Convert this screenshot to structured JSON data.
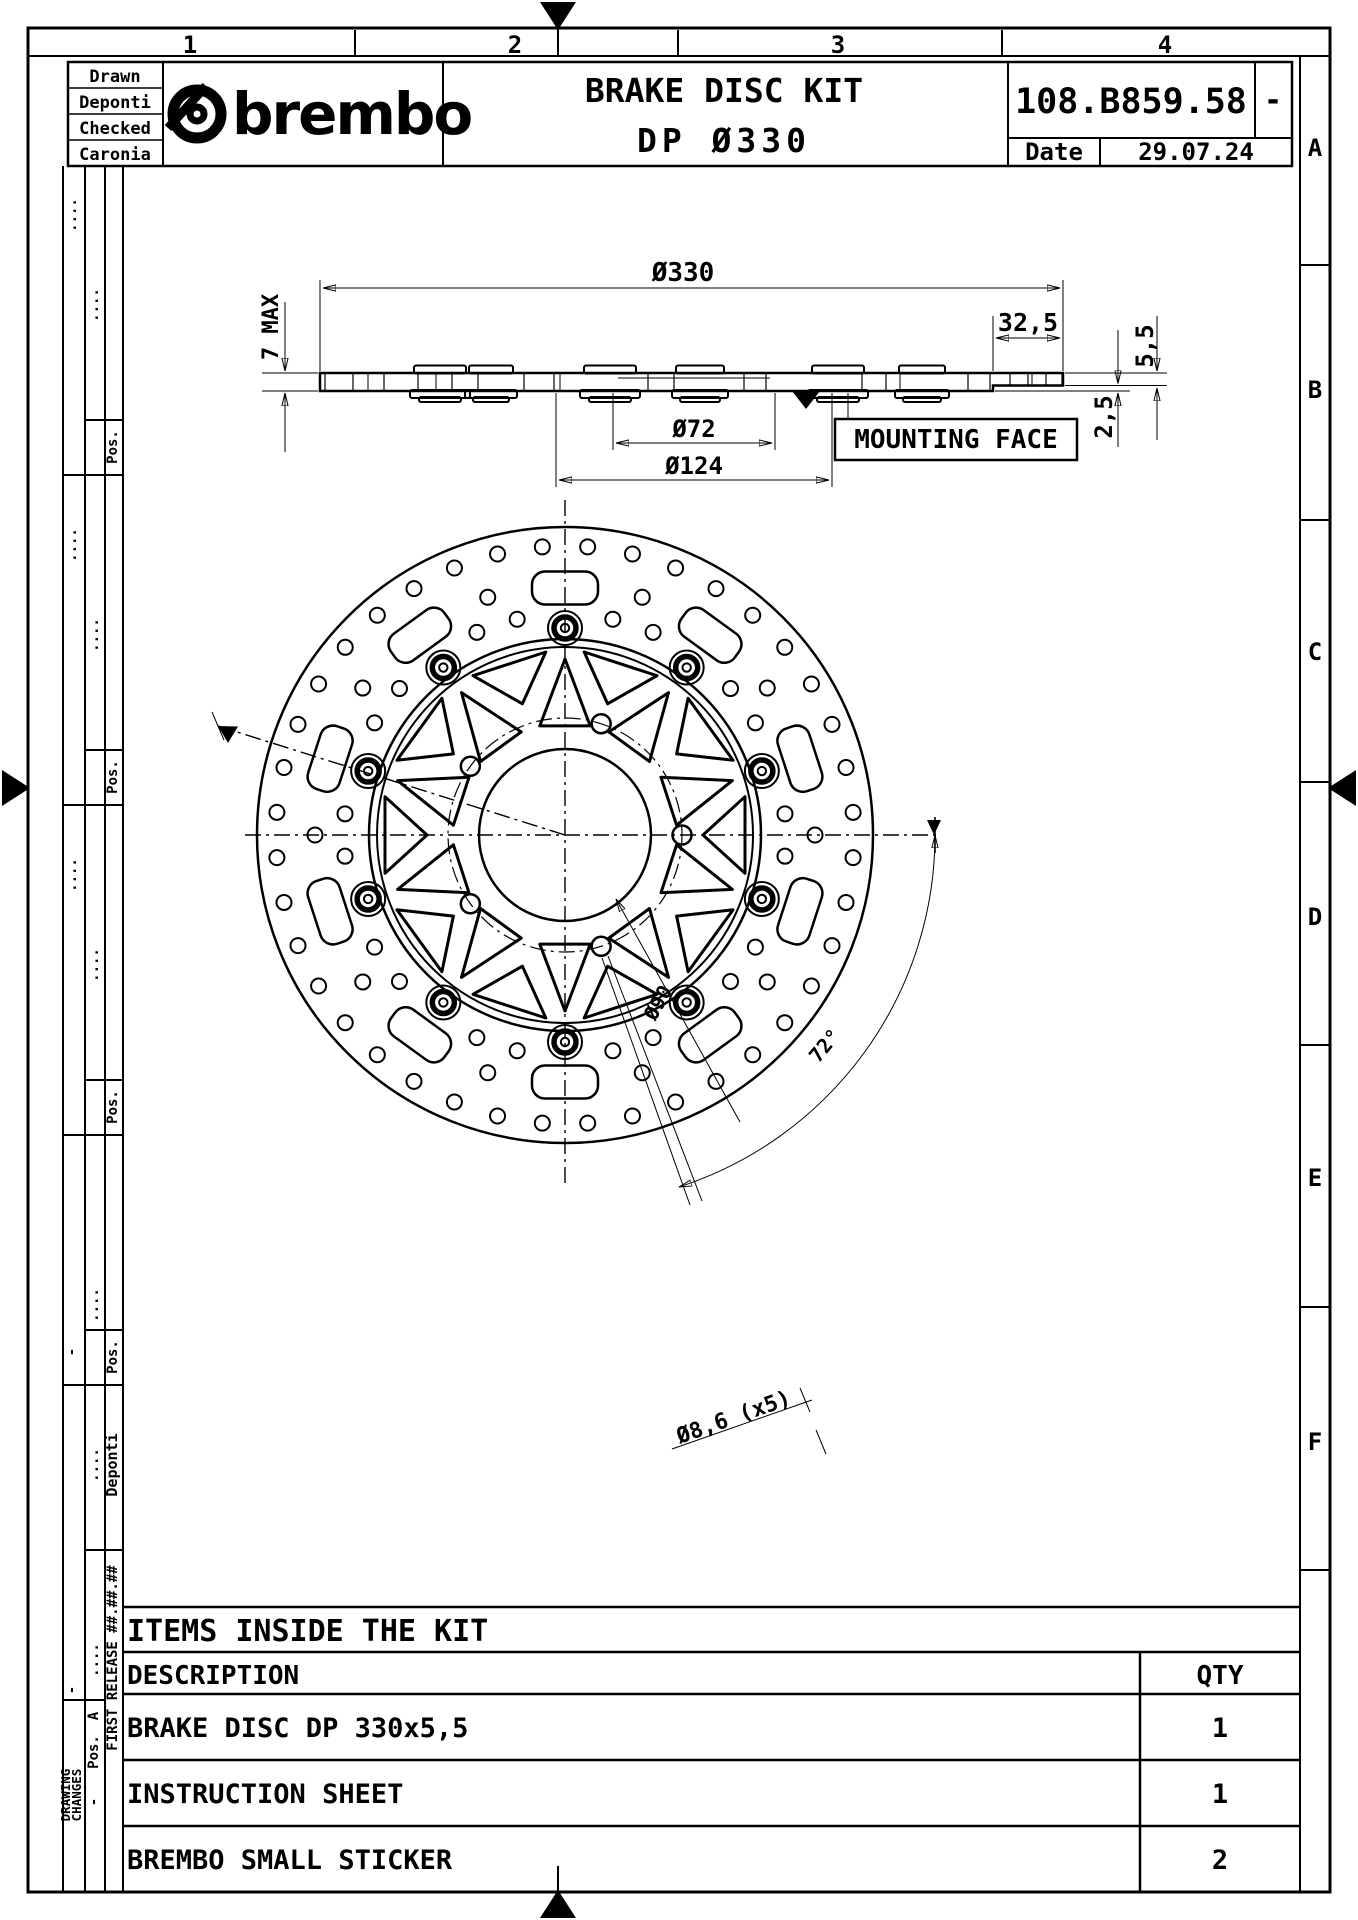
{
  "sheet": {
    "column_labels": [
      "1",
      "2",
      "3",
      "4"
    ],
    "row_labels": [
      "A",
      "B",
      "C",
      "D",
      "E",
      "F"
    ]
  },
  "title_block": {
    "drawn_label": "Drawn",
    "drawn_by": "Deponti",
    "checked_label": "Checked",
    "checked_by": "Caronia",
    "brand": "brembo",
    "title_line1": "BRAKE DISC KIT",
    "title_line2": "DP Ø330",
    "part_number": "108.B859.58",
    "revision": "-",
    "date_label": "Date",
    "date_value": "29.07.24"
  },
  "side_view": {
    "dim_outer_diameter": "Ø330",
    "dim_band_width": "32,5",
    "dim_max_thickness": "7 MAX",
    "dim_disc_thickness": "5,5",
    "dim_offset": "2,5",
    "dim_bore": "Ø72",
    "dim_bolt_circle": "Ø124",
    "mounting_face_label": "MOUNTING FACE"
  },
  "front_view": {
    "dim_center_bore": "Ø90",
    "dim_fixing_holes": "Ø8,6 (x5)",
    "dim_hole_angle": "72°"
  },
  "revision_margin": {
    "pos_label": "Pos.",
    "dots": "....",
    "dash": "-",
    "signature": "Deponti",
    "first_release": "FIRST RELEASE ##.##.##",
    "revision_letter": "A",
    "changes_line1": "DRAWING",
    "changes_line2": "CHANGES"
  },
  "kit_table": {
    "header": "ITEMS INSIDE THE KIT",
    "description_label": "DESCRIPTION",
    "qty_label": "QTY",
    "rows": [
      {
        "description": "BRAKE DISC DP 330x5,5",
        "qty": "1"
      },
      {
        "description": "INSTRUCTION SHEET",
        "qty": "1"
      },
      {
        "description": "BREMBO SMALL STICKER",
        "qty": "2"
      }
    ]
  }
}
